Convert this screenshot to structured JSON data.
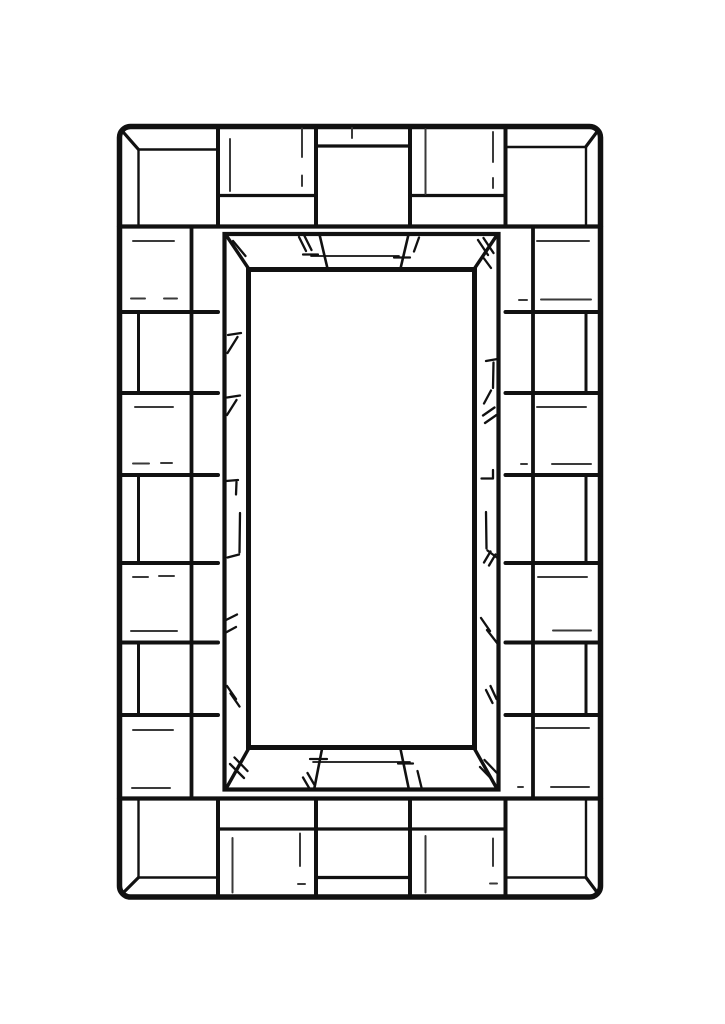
{
  "page": {
    "title": "Tiled mirror frame line drawing",
    "description": "Black-and-white coloring-page style line drawing of a rectangular wall mirror. The border is a mosaic of square and rectangular tiles: four corner squares with beveled corners, three tiles along the top and bottom edges with alternating narrow strips, and seven alternating tile rows along each side. Inside sits a beveled frame drawn in perspective with sketchy hatch marks, surrounding a blank white mirror surface."
  },
  "colors": {
    "paper": "#ffffff",
    "ink": "#111111",
    "sketch": "#3a3a3a"
  },
  "frame": {
    "corner_squares": 4,
    "top_edge_tiles": 3,
    "bottom_edge_tiles": 3,
    "left_edge_rows": 7,
    "right_edge_rows": 7,
    "bevel_hatch_marks": "present",
    "mirror_surface": "blank"
  }
}
